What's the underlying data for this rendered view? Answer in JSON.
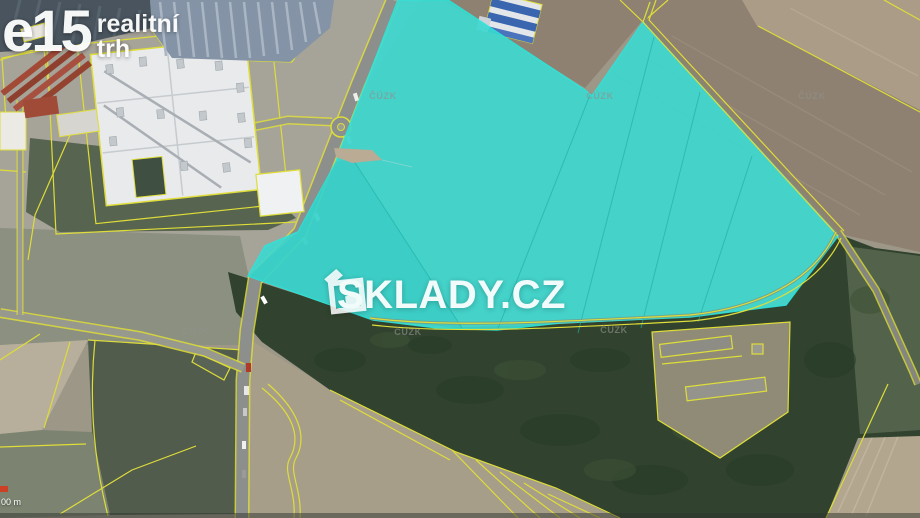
{
  "branding": {
    "logo_main": "e15",
    "logo_sub_line1": "realitní",
    "logo_sub_line2": "trh"
  },
  "watermark": {
    "text": "SKLADY.CZ",
    "icon": "box-logo-icon"
  },
  "map": {
    "attribution_label": "ČÚZK",
    "scalebar": {
      "text": "00 m"
    }
  },
  "colors": {
    "cyan": "#3bd9d1",
    "cyan-stroke": "#2ae6dc",
    "yline": "#dedd39",
    "forest": "#31432f",
    "road": "#8d8f8c",
    "scalebar": "#cc4125",
    "wm-white": "#ffffff"
  }
}
